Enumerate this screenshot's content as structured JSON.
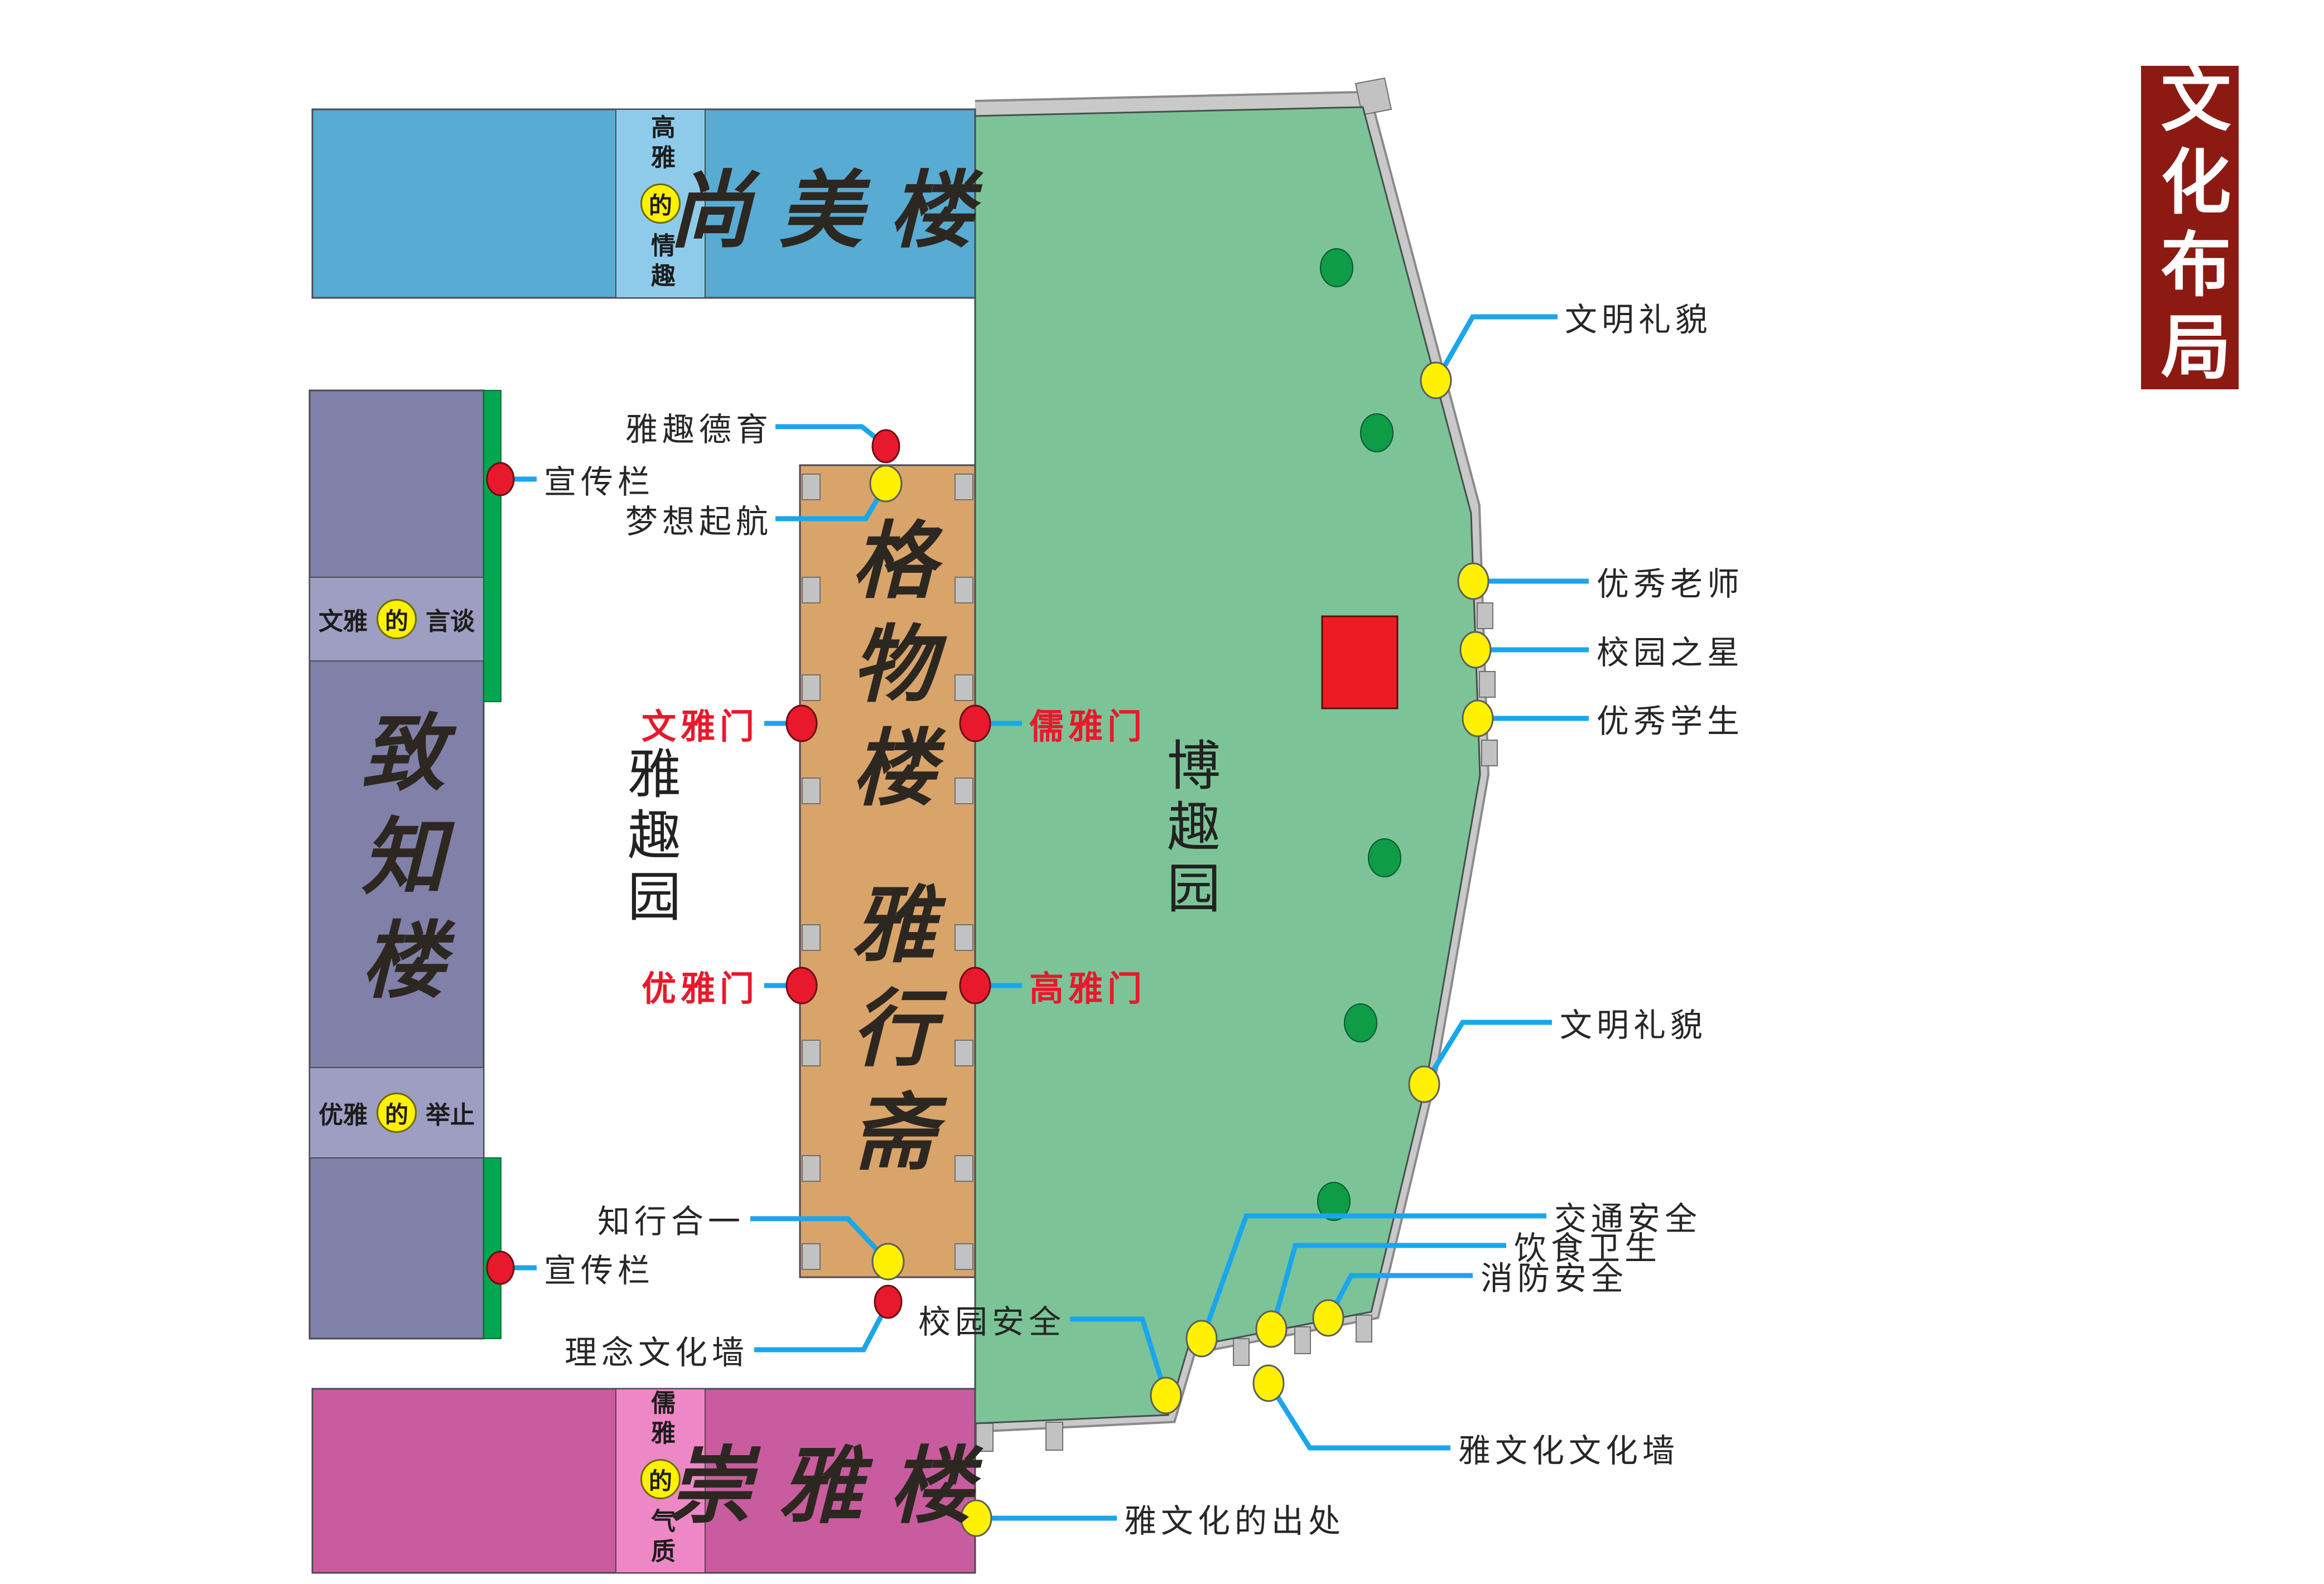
{
  "title": {
    "text": "文化布局"
  },
  "buildings": {
    "shangmei": {
      "name": "尚美楼",
      "band": {
        "before": "高雅",
        "de": "的",
        "after": "情趣"
      }
    },
    "zhizhi": {
      "name": "致知楼",
      "band_top": {
        "before": "文雅",
        "de": "的",
        "after": "言谈"
      },
      "band_bottom": {
        "before": "优雅",
        "de": "的",
        "after": "举止"
      }
    },
    "gewu": {
      "name": "格物楼"
    },
    "yaxingzhai": {
      "name": "雅行斋"
    },
    "chongya": {
      "name": "崇雅楼",
      "band": {
        "before": "儒雅",
        "de": "的",
        "after": "气质"
      }
    }
  },
  "areas": {
    "yaquyuan": "雅趣园",
    "boquyuan": "博趣园"
  },
  "labels": {
    "yaqu_deyu": "雅趣德育",
    "mengxiang_qihang": "梦想起航",
    "xuanchuanlan_top": "宣传栏",
    "xuanchuanlan_bottom": "宣传栏",
    "wenya_men": "文雅门",
    "ruya_men": "儒雅门",
    "youya_men": "优雅门",
    "gaoya_men": "高雅门",
    "zhixing_heyi": "知行合一",
    "linian_wenhuaqiang": "理念文化墙",
    "wenming_limao_top": "文明礼貌",
    "wenming_limao_mid": "文明礼貌",
    "youxiu_laoshi": "优秀老师",
    "xiaoyuan_zhixing": "校园之星",
    "youxiu_xuesheng": "优秀学生",
    "jiaotong_anquan": "交通安全",
    "yinshi_weisheng": "饮食卫生",
    "xiaofang_anquan": "消防安全",
    "xiaoyuan_anquan": "校园安全",
    "yawenhua_wenhuaqiang": "雅文化文化墙",
    "yawenhua_chuchu": "雅文化的出处"
  },
  "colors": {
    "park_green": "#7CC498",
    "tree_green": "#0E9C47",
    "wall_gray": "#C9C9C9",
    "blue_building": "#58ABD3",
    "blue_band": "#8ECBEA",
    "purple_dark": "#8080A8",
    "purple_light": "#9E9DC2",
    "green_strip": "#00A651",
    "orange_building": "#D9A469",
    "pink_building": "#C95C9F",
    "pink_band": "#EE87C5",
    "marker_red": "#E8192C",
    "marker_yellow": "#FFF100",
    "leader_blue": "#1BA6EC",
    "title_bg": "#8C1A13"
  }
}
